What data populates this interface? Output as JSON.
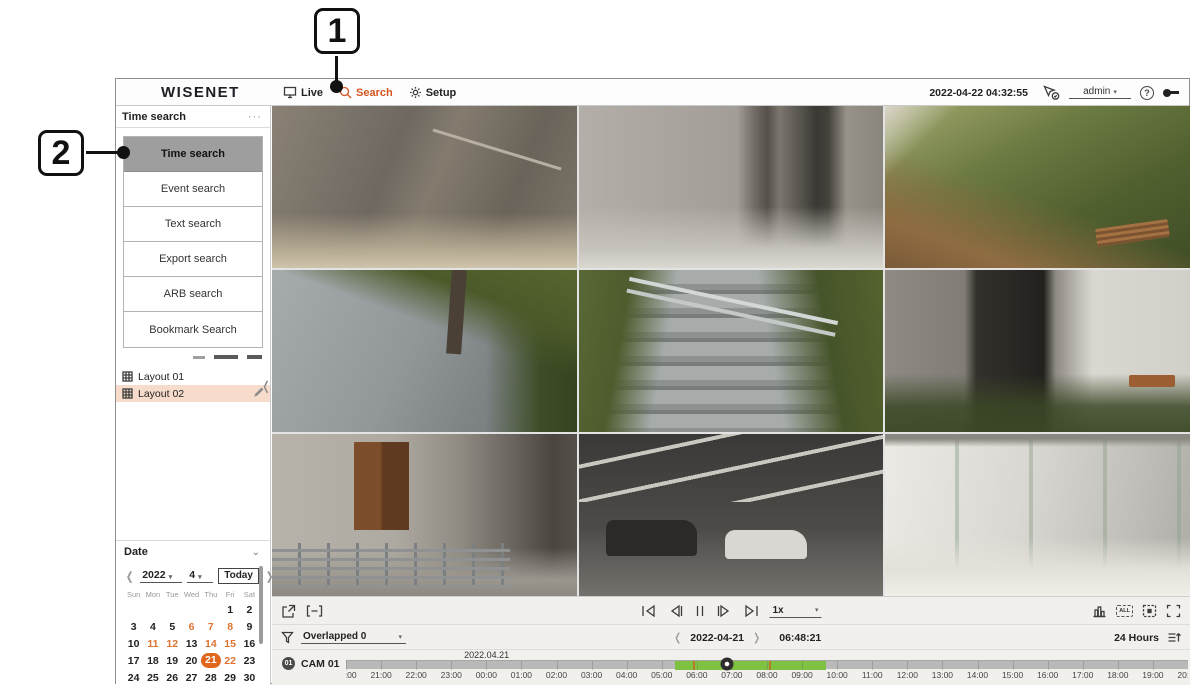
{
  "callouts": {
    "step1": "1",
    "step2": "2"
  },
  "top_bar": {
    "logo": "WISENET",
    "menu": [
      {
        "label": "Live"
      },
      {
        "label": "Search"
      },
      {
        "label": "Setup"
      }
    ],
    "active_menu": "Search",
    "datetime": "2022-04-22 04:32:55",
    "user": "admin"
  },
  "sidebar": {
    "panel_title": "Time search",
    "search_buttons": [
      "Time search",
      "Event search",
      "Text search",
      "Export search",
      "ARB search",
      "Bookmark Search"
    ],
    "selected_search": "Time search",
    "layouts": [
      {
        "label": "Layout 01",
        "selected": false
      },
      {
        "label": "Layout 02",
        "selected": true
      }
    ],
    "date_section": {
      "title": "Date",
      "year": "2022",
      "month": "4",
      "today_label": "Today",
      "weekdays": [
        "Sun",
        "Mon",
        "Tue",
        "Wed",
        "Thu",
        "Fri",
        "Sat"
      ],
      "weeks": [
        [
          "",
          "",
          "",
          "",
          "",
          "1",
          "2"
        ],
        [
          "3",
          "4",
          "5",
          "6",
          "7",
          "8",
          "9"
        ],
        [
          "10",
          "11",
          "12",
          "13",
          "14",
          "15",
          "16"
        ],
        [
          "17",
          "18",
          "19",
          "20",
          "21",
          "22",
          "23"
        ],
        [
          "24",
          "25",
          "26",
          "27",
          "28",
          "29",
          "30"
        ]
      ],
      "recorded_days": [
        6,
        7,
        8,
        11,
        12,
        14,
        15,
        22
      ],
      "selected_day": 21
    }
  },
  "cameras": [
    {
      "scene": "elevator interior"
    },
    {
      "scene": "lobby hallway with pillar"
    },
    {
      "scene": "garden path with bench"
    },
    {
      "scene": "tiled walkway with shrubs"
    },
    {
      "scene": "outdoor stairs with railing"
    },
    {
      "scene": "dark building entrance with shrubs"
    },
    {
      "scene": "corridor with wooden door and fence"
    },
    {
      "scene": "parking garage with cars"
    },
    {
      "scene": "bright glass corridor"
    }
  ],
  "controls": {
    "speed": "1x",
    "all_label": "ALL",
    "overlapped": "Overlapped 0",
    "nav_date": "2022-04-21",
    "nav_time": "06:48:21",
    "range_label": "24 Hours"
  },
  "timeline": {
    "channel_badge": "01",
    "channel_name": "CAM 01",
    "date_label": "2022.04.21",
    "date_label_pct": 16.7,
    "ticks": [
      "20:00",
      "21:00",
      "22:00",
      "23:00",
      "00:00",
      "01:00",
      "02:00",
      "03:00",
      "04:00",
      "05:00",
      "06:00",
      "07:00",
      "08:00",
      "09:00",
      "10:00",
      "11:00",
      "12:00",
      "13:00",
      "14:00",
      "15:00",
      "16:00",
      "17:00",
      "18:00",
      "19:00",
      "20:00"
    ],
    "recording": {
      "start_pct": 39.1,
      "end_pct": 57.0,
      "color": "#7fc241"
    },
    "events": [
      {
        "pct": 41.2
      },
      {
        "pct": 50.2
      }
    ],
    "playhead_pct": 45.2
  },
  "icons": {
    "more": "···",
    "collapse": "❬",
    "section_chevron": "⌄",
    "prev": "❬",
    "next": "❭",
    "caret": "▾"
  },
  "colors": {
    "accent": "#d4551e",
    "selected_day_bg": "#e0661c",
    "layout_highlight": "#f7dccc",
    "recording_green": "#7fc241",
    "selected_button_bg": "#9e9e9e"
  }
}
